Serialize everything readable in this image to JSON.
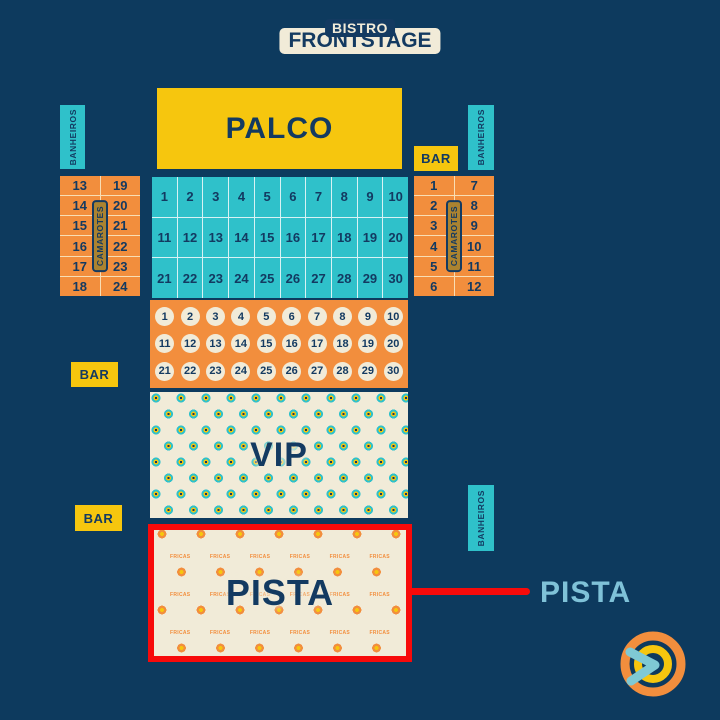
{
  "colors": {
    "background": "#0d3a5e",
    "yellow": "#f6c60e",
    "teal": "#2fc1ca",
    "orange": "#f28e3d",
    "cream": "#f1ebd8",
    "navy_text": "#133a61",
    "red": "#f70a0a",
    "callout_text": "#7fc2d8"
  },
  "map": {
    "palco": {
      "label": "PALCO"
    },
    "frontstage": {
      "label": "FRONTSTAGE",
      "cols": 10,
      "seats": [
        1,
        2,
        3,
        4,
        5,
        6,
        7,
        8,
        9,
        10,
        11,
        12,
        13,
        14,
        15,
        16,
        17,
        18,
        19,
        20,
        21,
        22,
        23,
        24,
        25,
        26,
        27,
        28,
        29,
        30
      ]
    },
    "bistro": {
      "label": "BISTRO",
      "cols": 10,
      "seats": [
        1,
        2,
        3,
        4,
        5,
        6,
        7,
        8,
        9,
        10,
        11,
        12,
        13,
        14,
        15,
        16,
        17,
        18,
        19,
        20,
        21,
        22,
        23,
        24,
        25,
        26,
        27,
        28,
        29,
        30
      ]
    },
    "vip": {
      "label": "VIP"
    },
    "pista": {
      "label": "PISTA",
      "watermark": "FRICAS",
      "watermark_per_row": 6,
      "watermark_row_tops": [
        24,
        62,
        100
      ]
    },
    "camarotes_left": {
      "label": "CAMAROTES",
      "left_column": [
        13,
        14,
        15,
        16,
        17,
        18
      ],
      "right_column": [
        19,
        20,
        21,
        22,
        23,
        24
      ]
    },
    "camarotes_right": {
      "label": "CAMAROTES",
      "left_column": [
        1,
        2,
        3,
        4,
        5,
        6
      ],
      "right_column": [
        7,
        8,
        9,
        10,
        11,
        12
      ]
    },
    "banheiros_top_left": {
      "label": "BANHEIROS"
    },
    "banheiros_top_right": {
      "label": "BANHEIROS"
    },
    "banheiros_bottom_right": {
      "label": "BANHEIROS"
    },
    "bar_right": {
      "label": "BAR"
    },
    "bar_left_upper": {
      "label": "BAR"
    },
    "bar_left_lower": {
      "label": "BAR"
    },
    "callout": {
      "label": "PISTA"
    },
    "logo": {
      "icon": "brand-swirl-logo"
    }
  }
}
